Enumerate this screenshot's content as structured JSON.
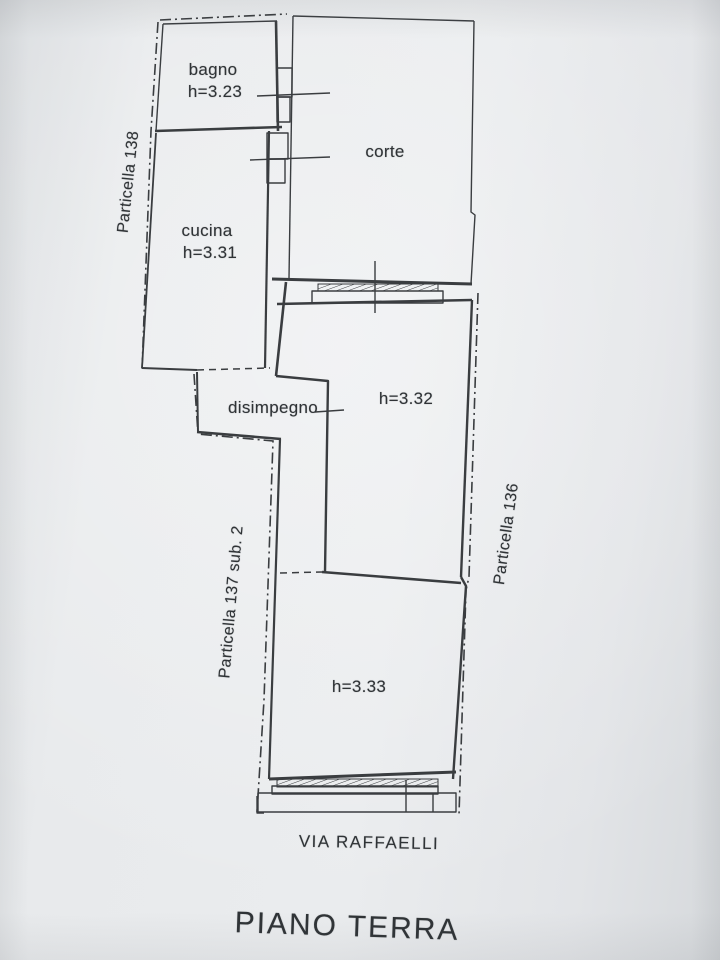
{
  "document": {
    "plan_title": "PIANO TERRA",
    "street": "VIA RAFFAELLI"
  },
  "rooms": {
    "bagno": {
      "name": "bagno",
      "height": "h=3.23"
    },
    "cucina": {
      "name": "cucina",
      "height": "h=3.31"
    },
    "corte": {
      "name": "corte"
    },
    "disimpegno": {
      "name": "disimpegno"
    },
    "room_332": {
      "height": "h=3.32"
    },
    "room_333": {
      "height": "h=3.33"
    }
  },
  "parcels": {
    "left_top": "Particella 138",
    "left_bottom": "Particella 137 sub. 2",
    "right": "Particella 136"
  },
  "colors": {
    "paper": "#e7e9eb",
    "ink": "#3a3d40"
  }
}
